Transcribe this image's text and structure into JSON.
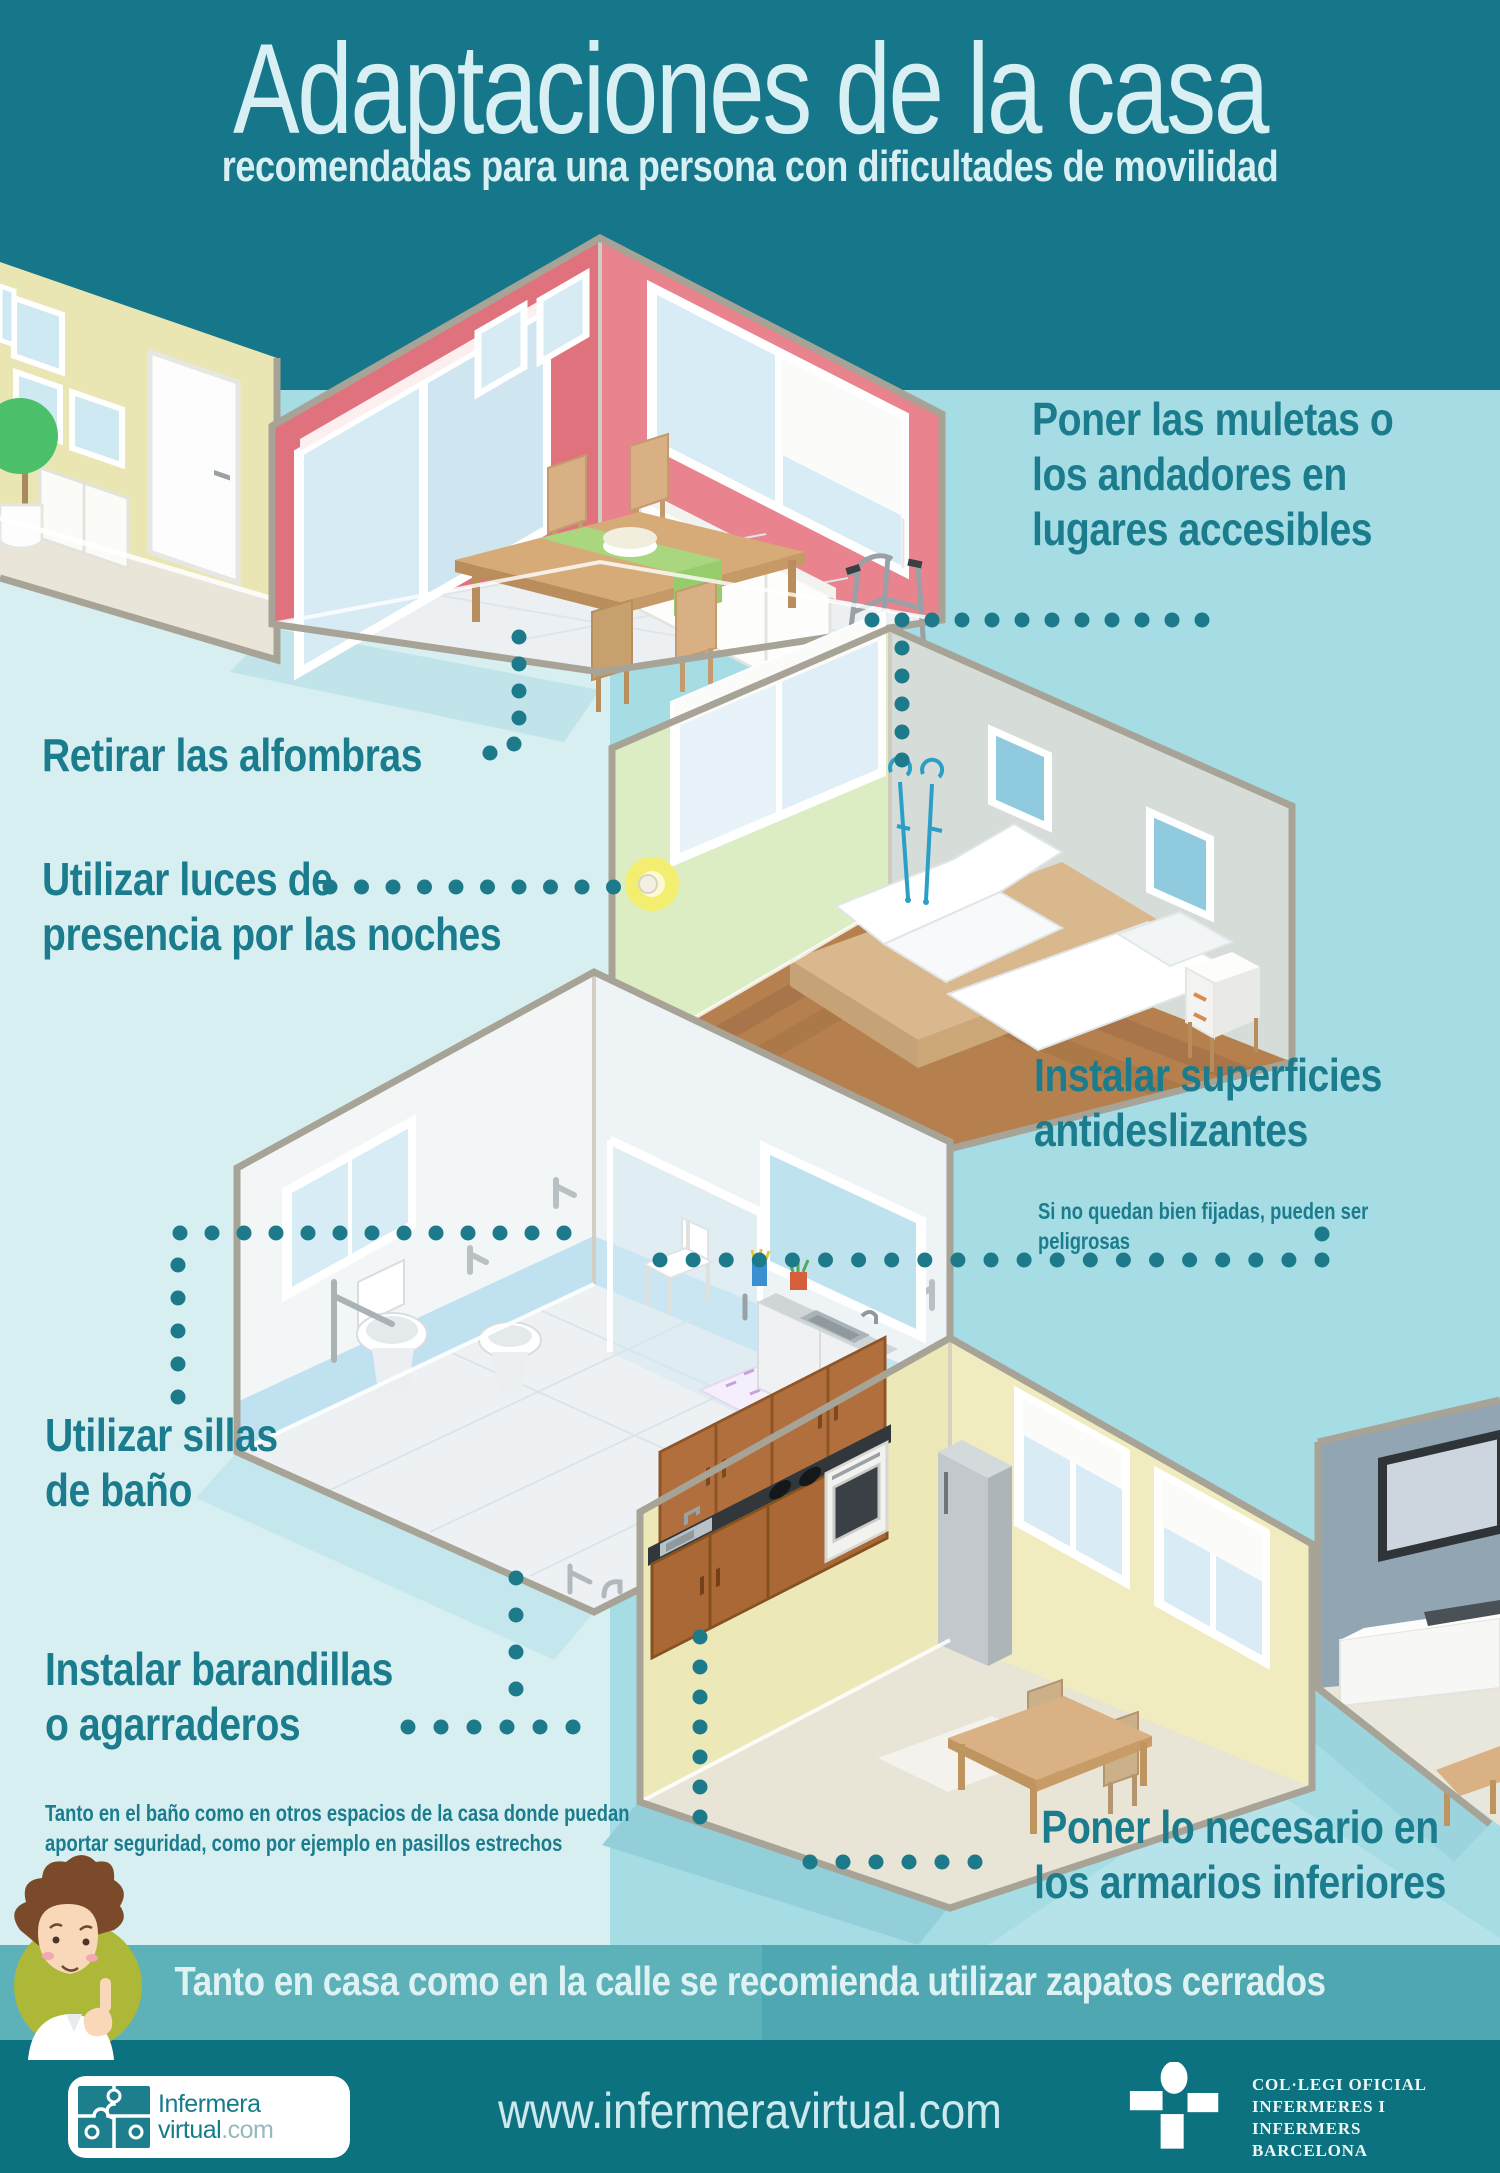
{
  "header": {
    "title": "Adaptaciones de la casa",
    "subtitle": "recomendadas para una persona con dificultades de movilidad"
  },
  "tips": {
    "crutches": {
      "text": "Poner las muletas o\nlos andadores en\nlugares accesibles"
    },
    "rugs": {
      "text": "Retirar las alfombras"
    },
    "lights": {
      "text": "Utilizar luces de\npresencia por las noches"
    },
    "surfaces": {
      "text": "Instalar superficies\nantideslizantes",
      "note": "Si no quedan bien fijadas, pueden ser peligrosas"
    },
    "chairs": {
      "text": "Utilizar sillas\nde baño"
    },
    "rails": {
      "text": "Instalar barandillas\no agarraderos",
      "note": "Tanto en el baño como en otros espacios de la casa donde puedan\naportar seguridad, como por ejemplo en pasillos estrechos"
    },
    "cabinets": {
      "text": "Poner lo necesario en\nlos armarios inferiores"
    }
  },
  "band": {
    "text": "Tanto en casa como en la calle se recomienda utilizar zapatos cerrados"
  },
  "footer": {
    "url": "www.infermeravirtual.com",
    "logo": {
      "line1": "Infermera",
      "line2": "virtual",
      "suffix": ".com"
    },
    "college_lines": [
      "COL·LEGI OFICIAL",
      "INFERMERES I INFERMERS",
      "BARCELONA"
    ]
  },
  "icons": {
    "avatar": "nurse-avatar",
    "logo": "puzzle-logo",
    "college": "college-cross-logo"
  },
  "colors": {
    "teal_dark": "#16778a",
    "teal_footer": "#0d7280",
    "band": "#55abb4",
    "accent_text": "#1b7c8d",
    "bg_mid": "#a6dce4",
    "bg_light": "#d8eff2",
    "title_text": "#d8f0f3"
  }
}
